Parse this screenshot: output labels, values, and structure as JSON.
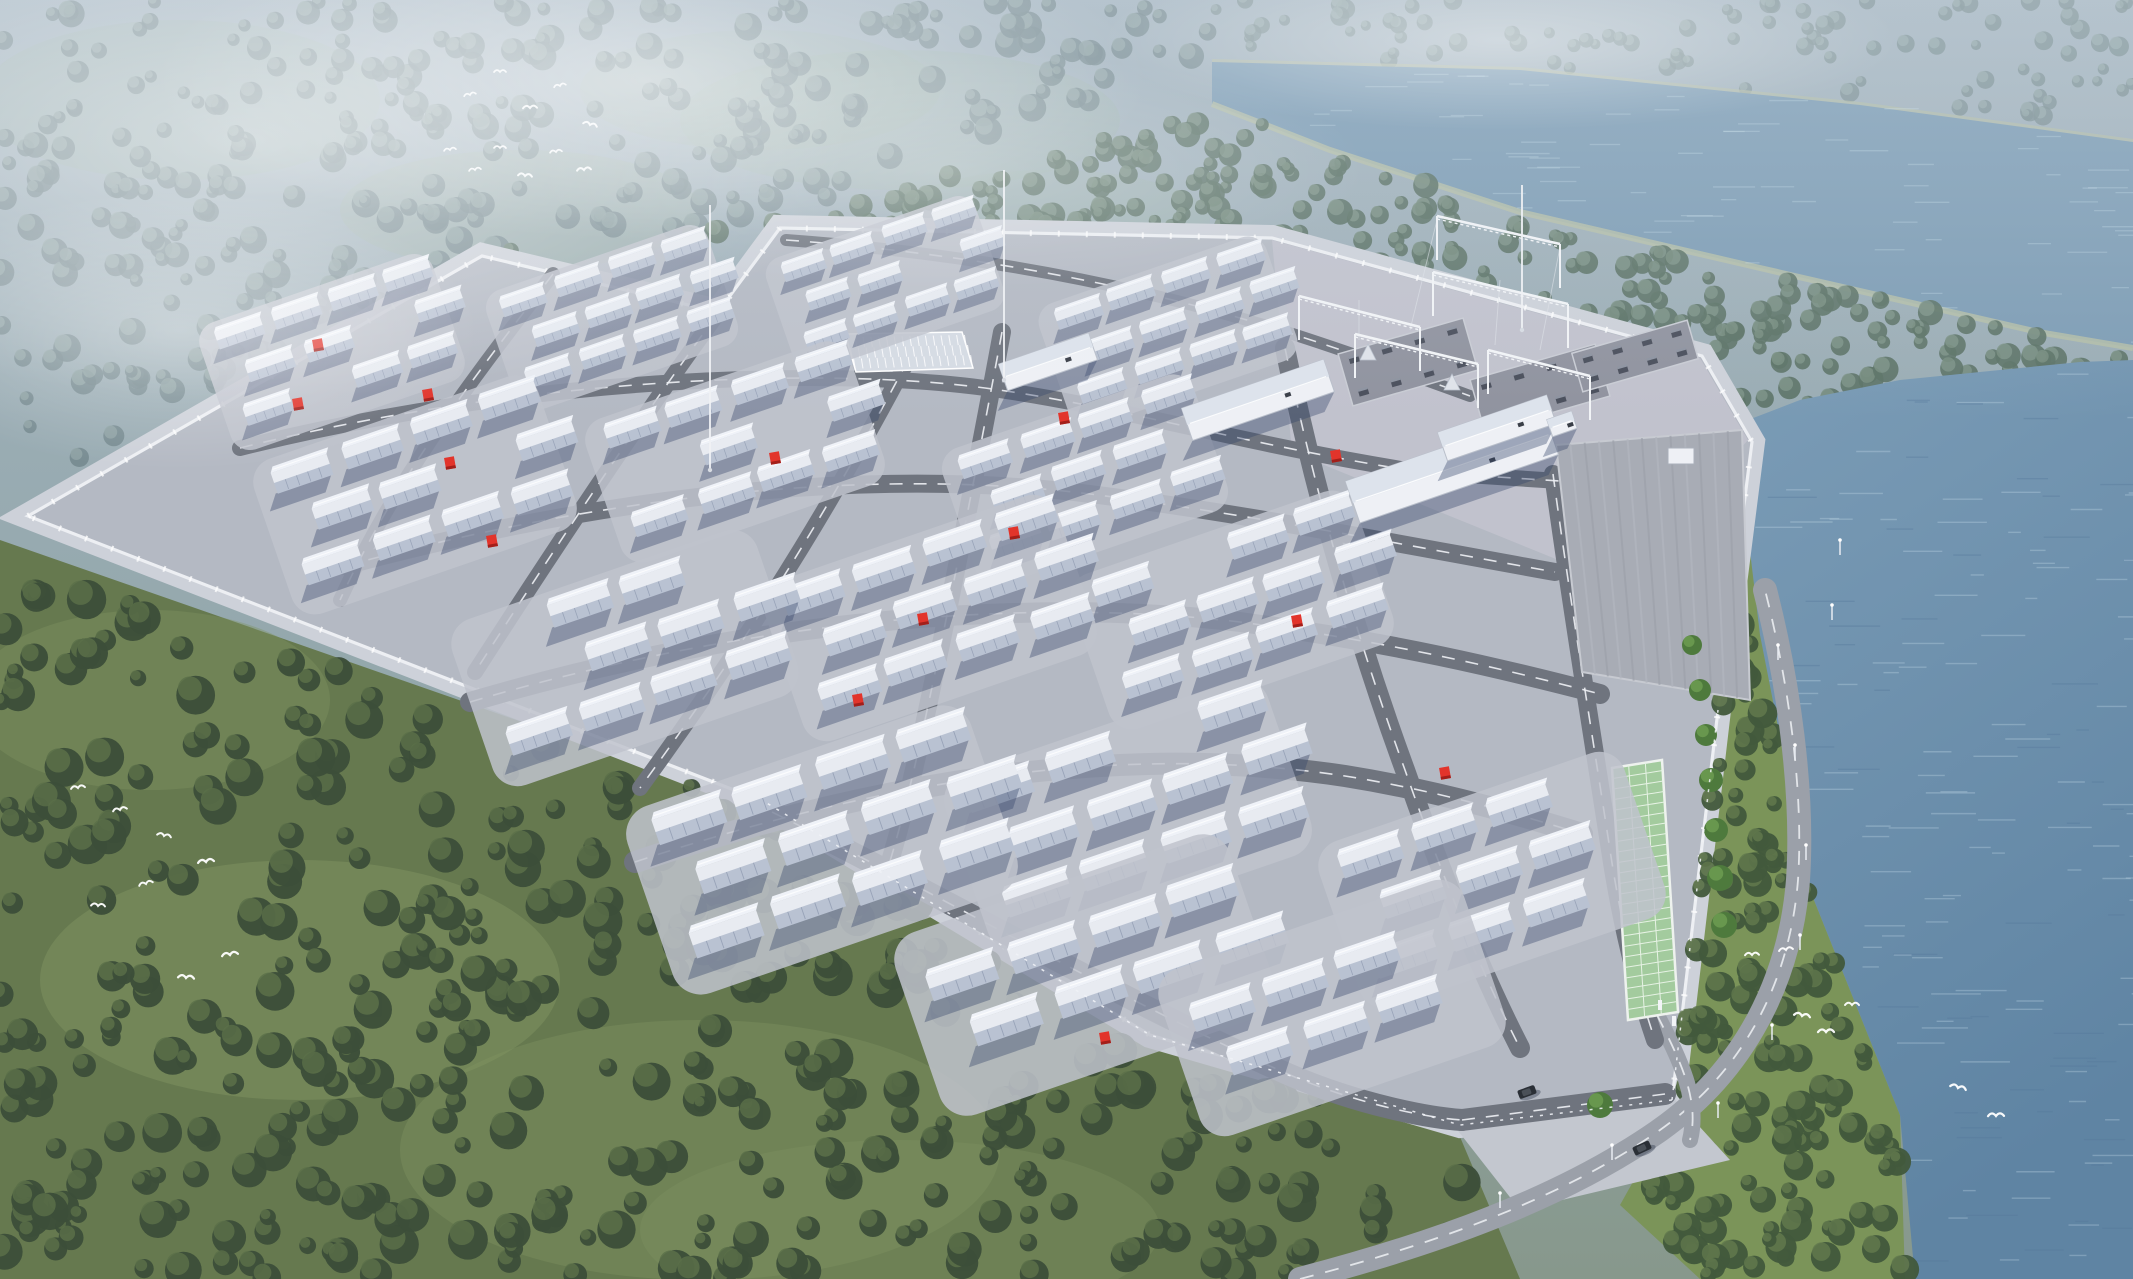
{
  "meta": {
    "title": "Aerial rendering of a battery energy storage power station beside a lake",
    "canvas": {
      "w": 2133,
      "h": 1279
    }
  },
  "palette": {
    "mist_top": "#a4b4c0",
    "mist_mid": "#93a7ab",
    "meadow_far": "#9db3a4",
    "forest_far_dark": "#74888e",
    "forest_far_light": "#8fa3a4",
    "forest_mid_dark": "#5d7468",
    "forest_mid_light": "#7a9184",
    "forest_near_dark": "#3c4e39",
    "forest_near_light": "#5a7049",
    "grass_sw": "#66794f",
    "grass_meadow": "#7f9361",
    "grass_bank": "#7b9459",
    "lake_fill": "#7e9db5",
    "river_top": "#7b9cb6",
    "river_bottom": "#5f84a3",
    "wave_light": "#c9dfec",
    "bank_line": "#b2bca6",
    "pavement": "#b4b9c3",
    "pad_fill": "#bfc3cd",
    "outer_band": "#cdd1d9",
    "wall_white": "#edeff3",
    "road": "#6f747e",
    "road_ext": "#9ba0a9",
    "dash_white": "#eef1f5",
    "substation_pad": "#c9c8d4",
    "gravel": "#90939f",
    "container_body": "#e8ebf1",
    "container_face": "#b9c2d2",
    "container_roof": "#eff2f8",
    "container_seam": "#98a3b8",
    "shadow_blue": "rgba(52,68,104,0.38)",
    "building_white": "#eef0f5",
    "building_roof": "#dde3ec",
    "warehouse_fill": "#a8acb5",
    "warehouse_stripe_a": "#b2b6bf",
    "warehouse_stripe_b": "#9da1ab",
    "green_strip": "#a3cb9e",
    "green_strip_line": "#e6f2e4",
    "conifer": "#4e7a3d",
    "red_accent": "#e2342b",
    "red_dark": "#a31f1a",
    "steel_white": "#f2f4f7",
    "bird_white": "#ffffff",
    "car_dark": "#2a2f36"
  },
  "background": {
    "far_meadows": [
      [
        520,
        210,
        180,
        60,
        0.35
      ],
      [
        900,
        120,
        220,
        70,
        0.3
      ],
      [
        1050,
        220,
        160,
        50,
        0.25
      ],
      [
        180,
        100,
        200,
        80,
        0.3
      ],
      [
        760,
        90,
        180,
        60,
        0.28
      ]
    ],
    "sw_meadows": [
      [
        300,
        980,
        260,
        120,
        0.5
      ],
      [
        700,
        1150,
        300,
        130,
        0.4
      ],
      [
        150,
        700,
        180,
        90,
        0.4
      ],
      [
        900,
        1230,
        260,
        90,
        0.35
      ]
    ]
  },
  "forest_regions": [
    {
      "name": "far-forest-top",
      "poly": [
        [
          0,
          0
        ],
        [
          1212,
          0
        ],
        [
          1212,
          55
        ],
        [
          760,
          225
        ],
        [
          470,
          252
        ],
        [
          0,
          500
        ]
      ],
      "count": 300,
      "rmin": 6,
      "rmax": 14,
      "dark": "#74888e",
      "light": "#8fa3a4",
      "op": 0.85
    },
    {
      "name": "forest-beyond-lake",
      "poly": [
        [
          1212,
          0
        ],
        [
          2133,
          0
        ],
        [
          2133,
          135
        ],
        [
          1850,
          100
        ],
        [
          1500,
          65
        ],
        [
          1215,
          55
        ]
      ],
      "count": 90,
      "rmin": 5,
      "rmax": 10,
      "dark": "#7b8f93",
      "light": "#93a7a8",
      "op": 0.8
    },
    {
      "name": "forest-north-belt",
      "poly": [
        [
          470,
          255
        ],
        [
          770,
          222
        ],
        [
          1215,
          108
        ],
        [
          1520,
          215
        ],
        [
          2035,
          335
        ],
        [
          2133,
          352
        ],
        [
          2133,
          395
        ],
        [
          1740,
          430
        ],
        [
          1700,
          356
        ],
        [
          1270,
          236
        ],
        [
          780,
          230
        ]
      ],
      "count": 240,
      "rmin": 6,
      "rmax": 13,
      "dark": "#5d7468",
      "light": "#7a9184",
      "op": 0.9
    },
    {
      "name": "forest-southwest",
      "poly": [
        [
          0,
          545
        ],
        [
          758,
          806
        ],
        [
          1142,
          1032
        ],
        [
          1450,
          1128
        ],
        [
          1505,
          1279
        ],
        [
          0,
          1279
        ]
      ],
      "count": 400,
      "rmin": 8,
      "rmax": 20,
      "dark": "#3c4e39",
      "light": "#5a7049",
      "op": 0.95
    },
    {
      "name": "forest-east-bank",
      "poly": [
        [
          1700,
          358
        ],
        [
          1755,
          442
        ],
        [
          1722,
          712
        ],
        [
          1676,
          1105
        ],
        [
          1620,
          1205
        ],
        [
          1700,
          1279
        ],
        [
          1905,
          1279
        ],
        [
          1900,
          1115
        ],
        [
          1812,
          895
        ],
        [
          1762,
          640
        ],
        [
          1738,
          430
        ]
      ],
      "count": 140,
      "rmin": 7,
      "rmax": 16,
      "dark": "#42593c",
      "light": "#60784c",
      "op": 0.95
    }
  ],
  "lake": {
    "poly": [
      [
        1212,
        62
      ],
      [
        1520,
        70
      ],
      [
        1860,
        105
      ],
      [
        2133,
        142
      ],
      [
        2133,
        348
      ],
      [
        2038,
        332
      ],
      [
        1760,
        268
      ],
      [
        1520,
        212
      ],
      [
        1330,
        150
      ],
      [
        1212,
        104
      ]
    ],
    "far_bank": [
      [
        1212,
        62
      ],
      [
        1520,
        70
      ],
      [
        1860,
        105
      ],
      [
        2133,
        142
      ]
    ],
    "near_bank": [
      [
        1212,
        104
      ],
      [
        1330,
        150
      ],
      [
        1520,
        212
      ],
      [
        1760,
        268
      ],
      [
        2038,
        332
      ],
      [
        2133,
        348
      ]
    ],
    "waves": 70
  },
  "river": {
    "poly": [
      [
        2133,
        360
      ],
      [
        2133,
        1279
      ],
      [
        1915,
        1279
      ],
      [
        1900,
        1115
      ],
      [
        1810,
        890
      ],
      [
        1760,
        635
      ],
      [
        1735,
        425
      ],
      [
        1800,
        400
      ],
      [
        1900,
        380
      ],
      [
        2000,
        370
      ],
      [
        2080,
        362
      ]
    ],
    "waves": 150
  },
  "grass_sw_poly": [
    [
      0,
      540
    ],
    [
      760,
      805
    ],
    [
      1145,
      1030
    ],
    [
      1455,
      1125
    ],
    [
      1520,
      1279
    ],
    [
      0,
      1279
    ]
  ],
  "site": {
    "outline": [
      [
        28,
        516
      ],
      [
        482,
        256
      ],
      [
        718,
        312
      ],
      [
        780,
        228
      ],
      [
        1272,
        238
      ],
      [
        1702,
        356
      ],
      [
        1752,
        442
      ],
      [
        1718,
        710
      ],
      [
        1672,
        1100
      ],
      [
        1460,
        1125
      ],
      [
        1150,
        1035
      ],
      [
        765,
        802
      ]
    ],
    "substation_pad": [
      [
        1272,
        240
      ],
      [
        1700,
        358
      ],
      [
        1748,
        440
      ],
      [
        1620,
        585
      ],
      [
        1292,
        452
      ]
    ]
  },
  "roads": {
    "internal": [
      {
        "d": "M 240 448 C 520 378 820 366 985 388 C 1120 406 1240 444 1420 472 L 1575 482",
        "w": 16
      },
      {
        "d": "M 345 566 C 640 486 900 470 1090 494 C 1250 514 1420 548 1555 572",
        "w": 18
      },
      {
        "d": "M 470 702 C 760 616 1040 598 1240 622 C 1390 642 1500 668 1600 694",
        "w": 20
      },
      {
        "d": "M 635 862 C 930 764 1160 748 1345 776 C 1445 792 1530 818 1582 834",
        "w": 22
      },
      {
        "d": "M 772 812 C 950 900 1120 1000 1290 1075 C 1360 1105 1430 1118 1462 1120",
        "w": 22
      },
      {
        "d": "M 1462 1120 L 1665 1094",
        "w": 22
      },
      {
        "d": "M 553 274 C 480 370 400 470 340 600",
        "w": 14
      },
      {
        "d": "M 716 316 C 640 420 560 540 475 672",
        "w": 16
      },
      {
        "d": "M 908 360 C 850 470 770 610 640 788",
        "w": 16
      },
      {
        "d": "M 1002 332 C 982 440 955 580 925 720 C 908 800 895 845 888 868",
        "w": 18
      },
      {
        "d": "M 1285 348 C 1310 470 1350 620 1405 770 C 1440 870 1480 970 1520 1048",
        "w": 20
      },
      {
        "d": "M 1553 474 C 1570 600 1590 720 1610 850 C 1622 930 1638 990 1655 1040",
        "w": 18
      },
      {
        "d": "M 786 240 C 950 252 1120 280 1280 330 C 1350 352 1420 378 1470 396",
        "w": 12
      }
    ],
    "external": [
      {
        "d": "M 1300 1279 C 1430 1245 1560 1200 1660 1130 C 1745 1070 1790 980 1798 880 C 1804 790 1788 680 1765 590",
        "w": 24
      },
      {
        "d": "M 1657 1015 C 1680 1060 1700 1100 1690 1140",
        "w": 16
      }
    ],
    "apron": [
      [
        1448,
        1118
      ],
      [
        1668,
        1092
      ],
      [
        1730,
        1160
      ],
      [
        1520,
        1210
      ]
    ]
  },
  "parking_pad": {
    "corners": [
      [
        845,
        334
      ],
      [
        962,
        332
      ],
      [
        973,
        368
      ],
      [
        856,
        372
      ]
    ],
    "fill": "#d6dbe4",
    "rows": [
      0.22,
      0.5,
      0.78
    ],
    "ticks": 15
  },
  "green_strip": {
    "corners": [
      [
        1612,
        768
      ],
      [
        1662,
        760
      ],
      [
        1678,
        1012
      ],
      [
        1628,
        1020
      ]
    ],
    "h_lines": 24
  },
  "warehouse": {
    "poly": [
      [
        1556,
        445
      ],
      [
        1742,
        430
      ],
      [
        1750,
        700
      ],
      [
        1582,
        672
      ]
    ],
    "stripes": 12,
    "hut": [
      1668,
      448,
      26,
      16
    ]
  },
  "clusters": {
    "list": [
      [
        332,
        352,
        0.78,
        3,
        4
      ],
      [
        612,
        318,
        0.74,
        3,
        4
      ],
      [
        885,
        284,
        0.7,
        3,
        4
      ],
      [
        1168,
        332,
        0.76,
        3,
        4
      ],
      [
        415,
        495,
        0.95,
        3,
        4
      ],
      [
        735,
        452,
        0.88,
        3,
        4
      ],
      [
        1085,
        480,
        0.84,
        3,
        4
      ],
      [
        625,
        658,
        1.02,
        3,
        4
      ],
      [
        930,
        618,
        0.98,
        3,
        4
      ],
      [
        1232,
        610,
        0.95,
        3,
        4
      ],
      [
        822,
        850,
        1.15,
        3,
        4
      ],
      [
        1128,
        815,
        1.08,
        3,
        4
      ],
      [
        1492,
        880,
        1.02,
        3,
        3
      ],
      [
        1085,
        975,
        1.12,
        2,
        4
      ],
      [
        1332,
        1008,
        1.02,
        2,
        3
      ]
    ]
  },
  "buildings": [
    {
      "cx": 1048,
      "cy": 362,
      "len": 95,
      "wid": 28
    },
    {
      "cx": 1258,
      "cy": 400,
      "len": 150,
      "wid": 34
    },
    {
      "cx": 1452,
      "cy": 468,
      "len": 210,
      "wid": 44
    },
    {
      "cx": 1497,
      "cy": 428,
      "len": 115,
      "wid": 30
    },
    {
      "cx": 1562,
      "cy": 424,
      "len": 26,
      "wid": 18
    }
  ],
  "substation": {
    "gravel_pads": [
      {
        "cx": 1408,
        "cy": 362,
        "len": 130,
        "wid": 54
      },
      {
        "cx": 1540,
        "cy": 388,
        "len": 130,
        "wid": 54
      },
      {
        "cx": 1635,
        "cy": 356,
        "len": 120,
        "wid": 40
      }
    ],
    "beams": [
      [
        1299,
        296,
        1420,
        327
      ],
      [
        1433,
        272,
        1568,
        304
      ],
      [
        1355,
        334,
        1478,
        364
      ],
      [
        1488,
        350,
        1590,
        376
      ],
      [
        1437,
        216,
        1560,
        244
      ]
    ],
    "leg_len": 44,
    "pyramids": [
      [
        1368,
        352
      ],
      [
        1452,
        382
      ]
    ],
    "wires": [
      [
        1437,
        220,
        1410,
        330
      ],
      [
        1560,
        247,
        1540,
        350
      ],
      [
        1359,
        300,
        1359,
        340
      ],
      [
        1500,
        280,
        1495,
        345
      ]
    ]
  },
  "masts": [
    [
      1004,
      380,
      170
    ],
    [
      1522,
      330,
      185
    ],
    [
      710,
      470,
      205
    ]
  ],
  "red_markers": [
    [
      318,
      345
    ],
    [
      428,
      395
    ],
    [
      298,
      404
    ],
    [
      450,
      463
    ],
    [
      492,
      541
    ],
    [
      775,
      458
    ],
    [
      1064,
      418
    ],
    [
      1014,
      533
    ],
    [
      923,
      619
    ],
    [
      1336,
      456
    ],
    [
      1297,
      621
    ],
    [
      1445,
      773
    ],
    [
      1105,
      1038
    ],
    [
      858,
      700
    ]
  ],
  "vehicles": [
    {
      "x": 1642,
      "y": 1148,
      "rot": -25
    },
    {
      "x": 1527,
      "y": 1092,
      "rot": -20
    }
  ],
  "lamps": [
    [
      1718,
      1118
    ],
    [
      1772,
      1040
    ],
    [
      1800,
      950
    ],
    [
      1806,
      860
    ],
    [
      1795,
      760
    ],
    [
      1778,
      660
    ],
    [
      1612,
      1160
    ],
    [
      1500,
      1208
    ],
    [
      1840,
      555
    ],
    [
      1832,
      620
    ]
  ],
  "conifers": [
    [
      1692,
      645,
      10
    ],
    [
      1700,
      690,
      11
    ],
    [
      1706,
      735,
      11
    ],
    [
      1711,
      780,
      12
    ],
    [
      1716,
      830,
      12
    ],
    [
      1720,
      878,
      13
    ],
    [
      1724,
      925,
      13
    ],
    [
      1600,
      1105,
      13
    ]
  ],
  "fence_paths": [
    "M 1672 1100 L 1460 1125 L 1150 1035 L 765 802",
    "M 1672 1100 L 1718 710"
  ],
  "gate_posts": [
    [
      1660,
      1008
    ],
    [
      1674,
      1024
    ]
  ],
  "birds": [
    [
      450,
      150,
      6
    ],
    [
      475,
      170,
      6
    ],
    [
      500,
      148,
      6
    ],
    [
      525,
      176,
      7
    ],
    [
      556,
      152,
      6
    ],
    [
      584,
      170,
      7
    ],
    [
      470,
      95,
      6
    ],
    [
      500,
      72,
      6
    ],
    [
      530,
      108,
      7
    ],
    [
      560,
      86,
      6
    ],
    [
      590,
      125,
      7
    ],
    [
      1752,
      955,
      7
    ],
    [
      1786,
      950,
      7
    ],
    [
      1802,
      1016,
      8
    ],
    [
      1826,
      1032,
      8
    ],
    [
      1852,
      1005,
      7
    ],
    [
      1958,
      1088,
      8
    ],
    [
      1996,
      1116,
      8
    ],
    [
      78,
      788,
      7
    ],
    [
      120,
      810,
      7
    ],
    [
      164,
      836,
      7
    ],
    [
      206,
      862,
      8
    ],
    [
      146,
      884,
      7
    ],
    [
      98,
      906,
      7
    ],
    [
      230,
      955,
      8
    ],
    [
      186,
      978,
      8
    ]
  ],
  "mist_overlays": [
    [
      250,
      140,
      600,
      260,
      0.5
    ],
    [
      650,
      80,
      500,
      160,
      0.45
    ],
    [
      180,
      330,
      300,
      140,
      0.35
    ],
    [
      1500,
      40,
      400,
      90,
      0.4
    ],
    [
      950,
      170,
      420,
      120,
      0.25
    ]
  ],
  "top_haze": {
    "height": 420,
    "opacity": 0.3
  }
}
